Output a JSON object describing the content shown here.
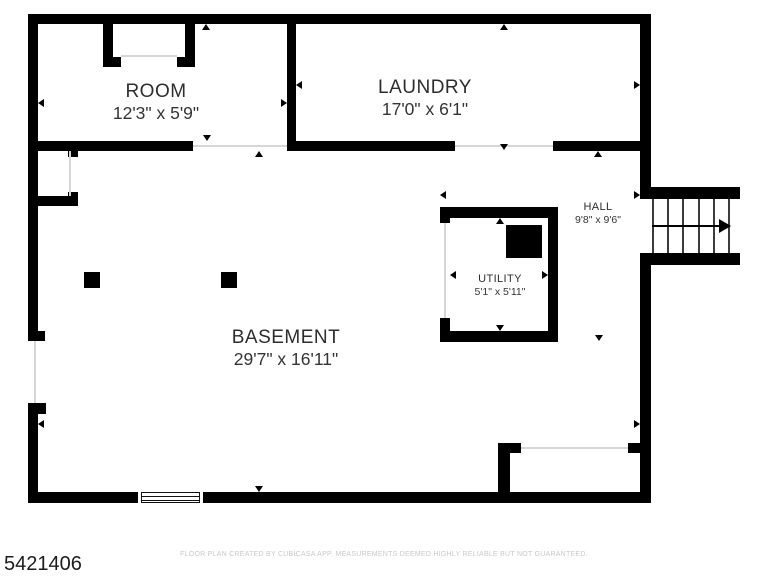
{
  "rooms": {
    "room": {
      "name": "ROOM",
      "dims": "12'3\" x 5'9\""
    },
    "laundry": {
      "name": "LAUNDRY",
      "dims": "17'0\" x 6'1\""
    },
    "hall": {
      "name": "HALL",
      "dims": "9'8\" x 9'6\""
    },
    "utility": {
      "name": "UTILITY",
      "dims": "5'1\" x 5'11\""
    },
    "basement": {
      "name": "BASEMENT",
      "dims": "29'7\" x 16'11\""
    }
  },
  "footer": {
    "listing_id": "5421406",
    "disclaimer": "FLOOR PLAN CREATED BY CUBICASA APP. MEASUREMENTS DEEMED HIGHLY RELIABLE BUT NOT GUARANTEED."
  },
  "colors": {
    "background": "#ffffff",
    "wall": "#000000",
    "room_text": "#2d2d2d",
    "disclaimer_text": "#c8c8c8"
  }
}
